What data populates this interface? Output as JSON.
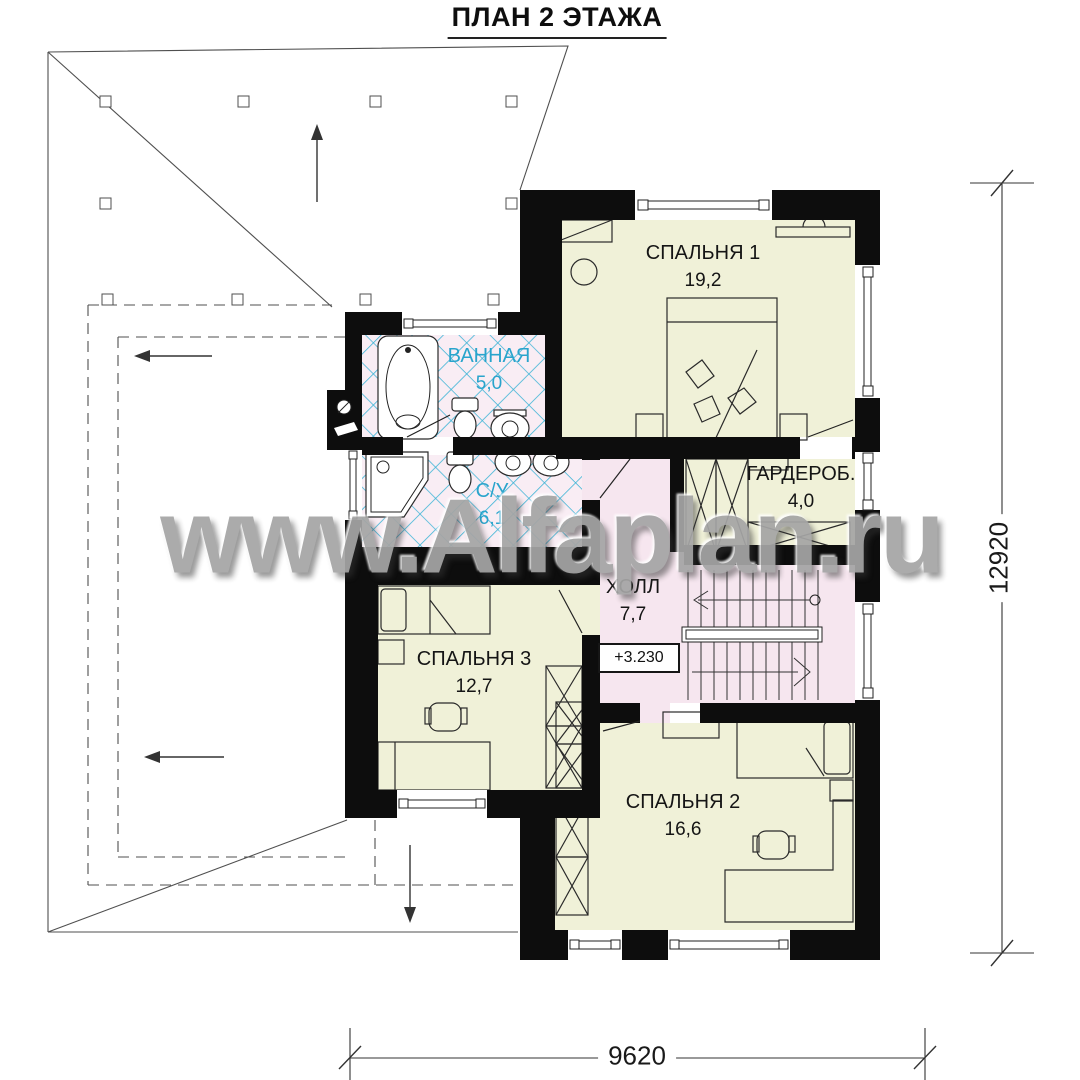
{
  "title": "ПЛАН 2 ЭТАЖА",
  "watermark": "www.Alfaplan.ru",
  "rooms": [
    {
      "id": "bedroom-1",
      "name": "СПАЛЬНЯ 1",
      "area": "19,2"
    },
    {
      "id": "bathroom",
      "name": "ВАННАЯ",
      "area": "5,0"
    },
    {
      "id": "wc",
      "name": "С/У",
      "area": "6,1"
    },
    {
      "id": "wardrobe",
      "name": "ГАРДЕРОБ.",
      "area": "4,0"
    },
    {
      "id": "hall",
      "name": "ХОЛЛ",
      "area": "7,7"
    },
    {
      "id": "bedroom-3",
      "name": "СПАЛЬНЯ 3",
      "area": "12,7"
    },
    {
      "id": "bedroom-2",
      "name": "СПАЛЬНЯ 2",
      "area": "16,6"
    }
  ],
  "elevation_mark": "+3.230",
  "dimensions": {
    "vertical": "12920",
    "horizontal": "9620"
  },
  "colors": {
    "wall": "#0d0d0d",
    "room": "#f0f1d8",
    "tile_bg": "#f9edf4",
    "tile_line": "#3db4d6",
    "hall": "#f6e6ef",
    "wet_label": "#29a4cc"
  }
}
